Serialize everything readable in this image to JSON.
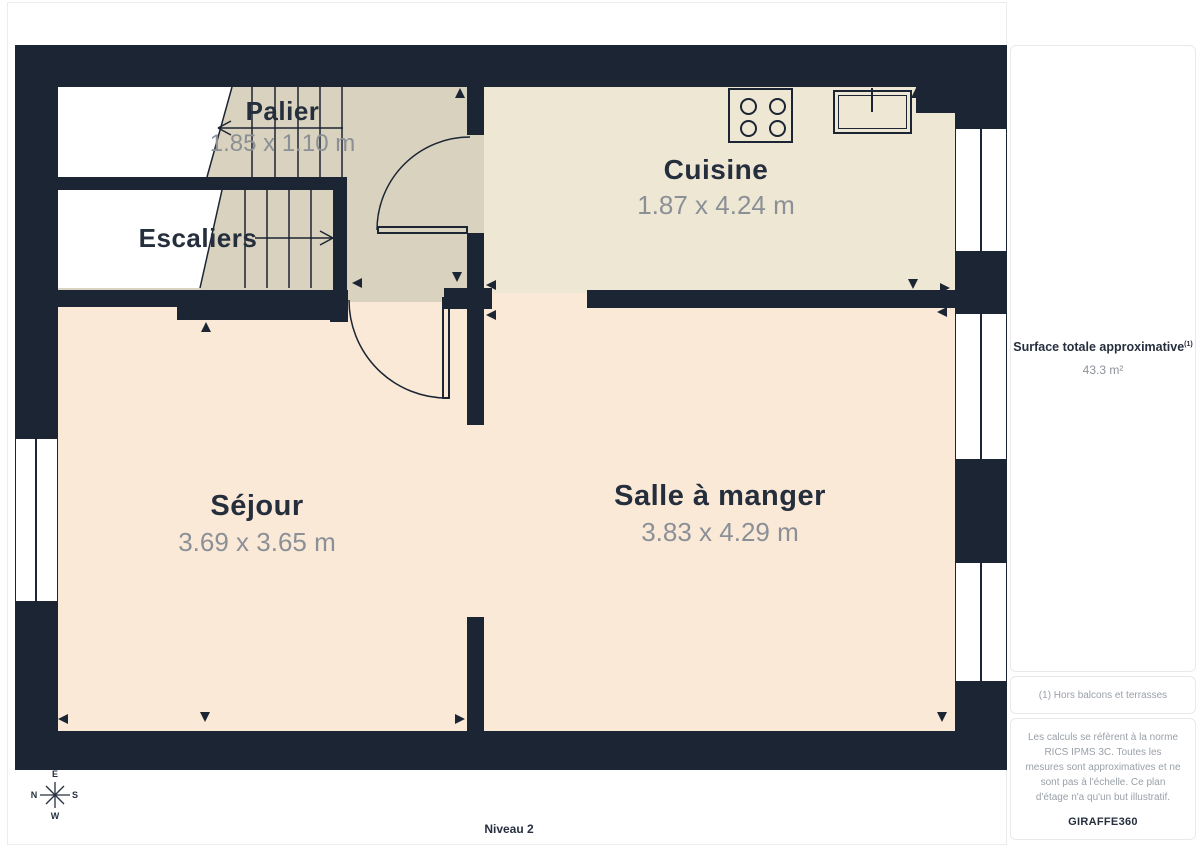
{
  "floorplan": {
    "level_label": "Niveau 2",
    "rooms": [
      {
        "name": "Palier",
        "dims": "1.85 x 1.10 m"
      },
      {
        "name": "Escaliers",
        "dims": ""
      },
      {
        "name": "Cuisine",
        "dims": "1.87 x 4.24 m"
      },
      {
        "name": "Séjour",
        "dims": "3.69 x 3.65 m"
      },
      {
        "name": "Salle à manger",
        "dims": "3.83 x 4.29 m"
      }
    ],
    "compass": {
      "top": "E",
      "bottom": "W",
      "left": "N",
      "right": "S"
    }
  },
  "sidebar": {
    "surface_label": "Surface totale approximative",
    "surface_superscript": "(1)",
    "surface_value": "43.3 m²",
    "footnote": "(1) Hors balcons et terrasses",
    "disclaimer": "Les calculs se réfèrent à la norme RICS IPMS 3C. Toutes les mesures sont approximatives et ne sont pas à l'échelle. Ce plan d'étage n'a qu'un but illustratif.",
    "brand": "GIRAFFE",
    "brand_suffix": "360"
  },
  "colors": {
    "wall": "#1c2533",
    "floor_living": "#fbe9d8",
    "floor_kitchen": "#eee7d4",
    "floor_stairs": "#d9d2be",
    "text_dark": "#252e3c",
    "text_dim": "#8b9097",
    "text_sidebar": "#9aa0a8"
  }
}
